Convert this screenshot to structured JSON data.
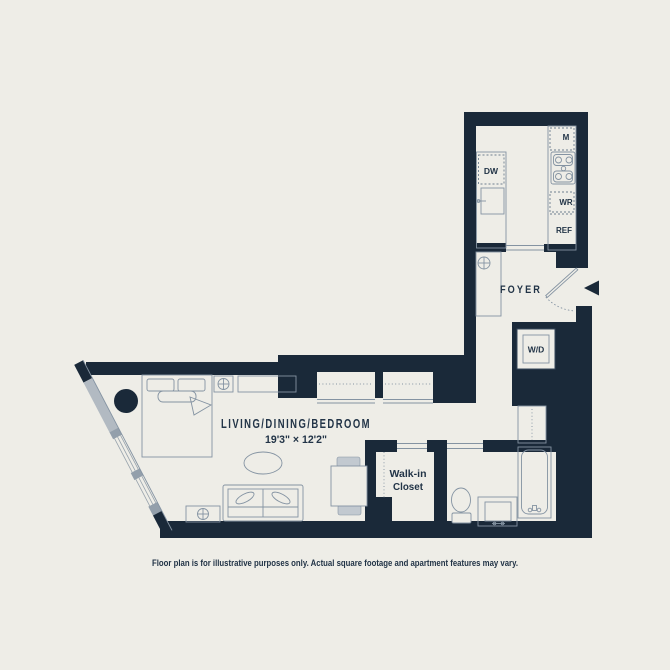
{
  "plan": {
    "rooms": {
      "living": {
        "name": "LIVING/DINING/BEDROOM",
        "dimensions": "19'3\" × 12'2\""
      },
      "foyer": {
        "name": "FOYER"
      },
      "walk_in_closet": {
        "line1": "Walk-in",
        "line2": "Closet"
      }
    },
    "appliances": {
      "dishwasher": "DW",
      "microwave": "M",
      "wine_refrigerator": "WR",
      "refrigerator": "REF",
      "washer_dryer": "W/D"
    },
    "disclaimer": "Floor plan is for illustrative purposes only. Actual square footage and apartment features may vary.",
    "colors": {
      "wall": "#1a2939",
      "background": "#eeede7",
      "furniture_line": "#8493a2",
      "window_gray": "#b2bac2"
    }
  }
}
